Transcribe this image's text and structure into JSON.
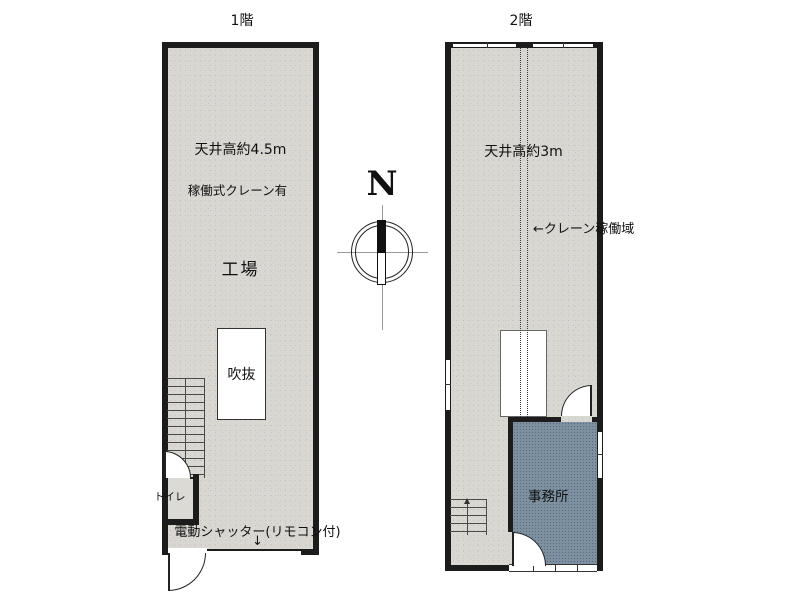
{
  "page": {
    "floor1_label": "1階",
    "floor2_label": "2階"
  },
  "floor1": {
    "ceiling_note": "天井高約4.5m",
    "crane_note": "稼働式クレーン有",
    "room_label": "工場",
    "void_label": "吹抜",
    "toilet_label": "トイレ",
    "shutter_note": "電動シャッター(リモコン付)",
    "shutter_arrow": "↓"
  },
  "floor2": {
    "ceiling_note": "天井高約3m",
    "crane_area_note": "←クレーン稼働域",
    "office_label": "事務所"
  },
  "compass": {
    "north_label": "N"
  },
  "colors": {
    "floor_fill": "#d8d7d2",
    "office_fill": "#7d91a1",
    "wall": "#1c1c1c",
    "paper": "#ffffff"
  }
}
